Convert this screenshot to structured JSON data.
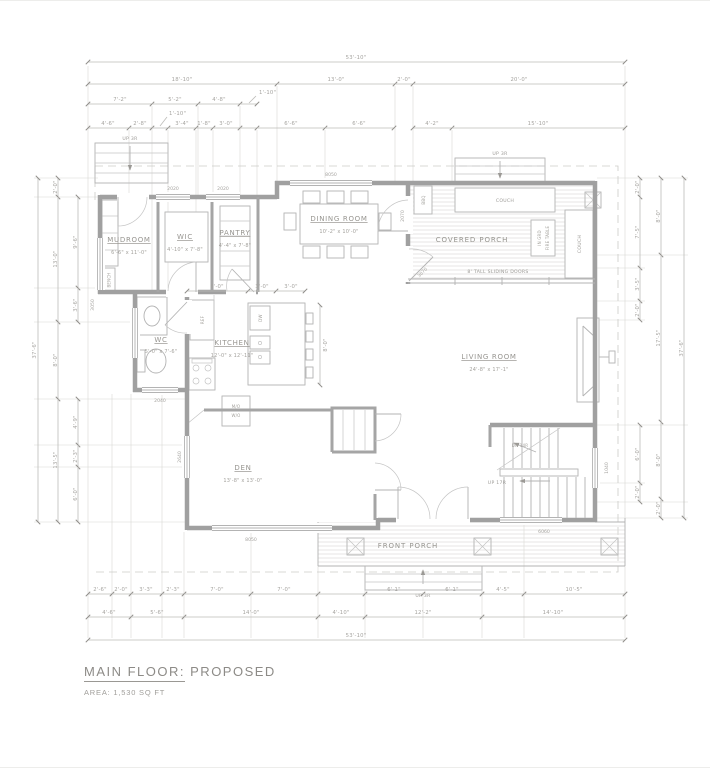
{
  "title": {
    "label": "MAIN FLOOR:",
    "suffix": "PROPOSED",
    "area": "AREA: 1,530 SQ FT"
  },
  "rooms": {
    "mudroom": {
      "name": "MUDROOM",
      "dims": "6'-6\" x 11'-0\""
    },
    "wic": {
      "name": "WIC",
      "dims": "4'-10\" x 7'-8\""
    },
    "pantry": {
      "name": "PANTRY",
      "dims": "4'-4\" x 7'-8\""
    },
    "dining": {
      "name": "DINING ROOM",
      "dims": "10'-2\" x 10'-0\""
    },
    "covered_porch": {
      "name": "COVERED PORCH"
    },
    "kitchen": {
      "name": "KITCHEN",
      "dims": "12'-0\" x 12'-11\""
    },
    "wc": {
      "name": "WC",
      "dims": "5'-0\" x 7'-6\""
    },
    "living": {
      "name": "LIVING ROOM",
      "dims": "24'-8\" x 17'-1\""
    },
    "den": {
      "name": "DEN",
      "dims": "13'-8\" x 13'-0\""
    },
    "front_porch": {
      "name": "FRONT PORCH"
    }
  },
  "fixtures": {
    "bench": "BENCH",
    "ref": "REF",
    "dw": "DW",
    "couch_top": "COUCH",
    "couch_side": "COUCH",
    "bbq": "BBQ",
    "fire_table_1": "IN GRD",
    "fire_table_2": "FIRE TABLE",
    "mo": "M/O",
    "wo": "W/O",
    "sliding": "8' TALL SLIDING DOORS",
    "up3r_stoop": "UP 3R",
    "up3r_porch": "UP 3R",
    "up3r_front": "UP 3R",
    "up17r": "UP 17R",
    "dn14r": "DN 14R"
  },
  "tags": {
    "wic_win": "2020",
    "pantry_win": "2020",
    "dining_win": "8050",
    "mud_win": "3050",
    "wc_win": "2040",
    "den_side_win": "2640",
    "den_front_win": "8050",
    "stair_win": "6060",
    "stair_side_win": "1040",
    "porch_door": "2070",
    "porch_door2": "3070"
  },
  "dims": {
    "top1": [
      "53'-10\""
    ],
    "top2": [
      "18'-10\"",
      "13'-0\"",
      "2'-0\"",
      "20'-0\""
    ],
    "top3": [
      "7'-2\"",
      "5'-2\"",
      "4'-8\"",
      "1'-10\""
    ],
    "top4_leader": "1'-10\"",
    "top4": [
      "4'-6\"",
      "2'-8\"",
      "3'-4\"",
      "1'-8\"",
      "3'-0\"",
      "6'-6\"",
      "6'-6\"",
      "4'-2\"",
      "15'-10\""
    ],
    "bottom1": [
      "2'-6\"",
      "2'-0\"",
      "3'-3\"",
      "2'-3\"",
      "7'-0\"",
      "7'-0\"",
      "6'-1\"",
      "6'-1\"",
      "4'-5\"",
      "10'-5\""
    ],
    "bottom2": [
      "4'-6\"",
      "5'-6\"",
      "14'-0\"",
      "4'-10\"",
      "12'-2\"",
      "14'-10\""
    ],
    "bottom3": [
      "53'-10\""
    ],
    "left_outer": [
      "37'-6\""
    ],
    "left_mid": [
      "2'-0\"",
      "13'-0\"",
      "8'-0\"",
      "13'-5\""
    ],
    "left_inner": [
      "9'-6\"",
      "3'-6\"",
      "4'-9\"",
      "2'-3\"",
      "6'-0\""
    ],
    "right_inner": [
      "2'-0\"",
      "7'-5\"",
      "3'-5\"",
      "2'-0\"",
      "6'-0\"",
      "2'-0\""
    ],
    "right_mid": [
      "8'-0\"",
      "17'-5\"",
      "8'-0\"",
      "2'-0\""
    ],
    "right_outer": [
      "37'-6\""
    ],
    "kitchen": [
      "6'-0\"",
      "3'-0\"",
      "3'-0\"",
      "8'-0\""
    ]
  }
}
